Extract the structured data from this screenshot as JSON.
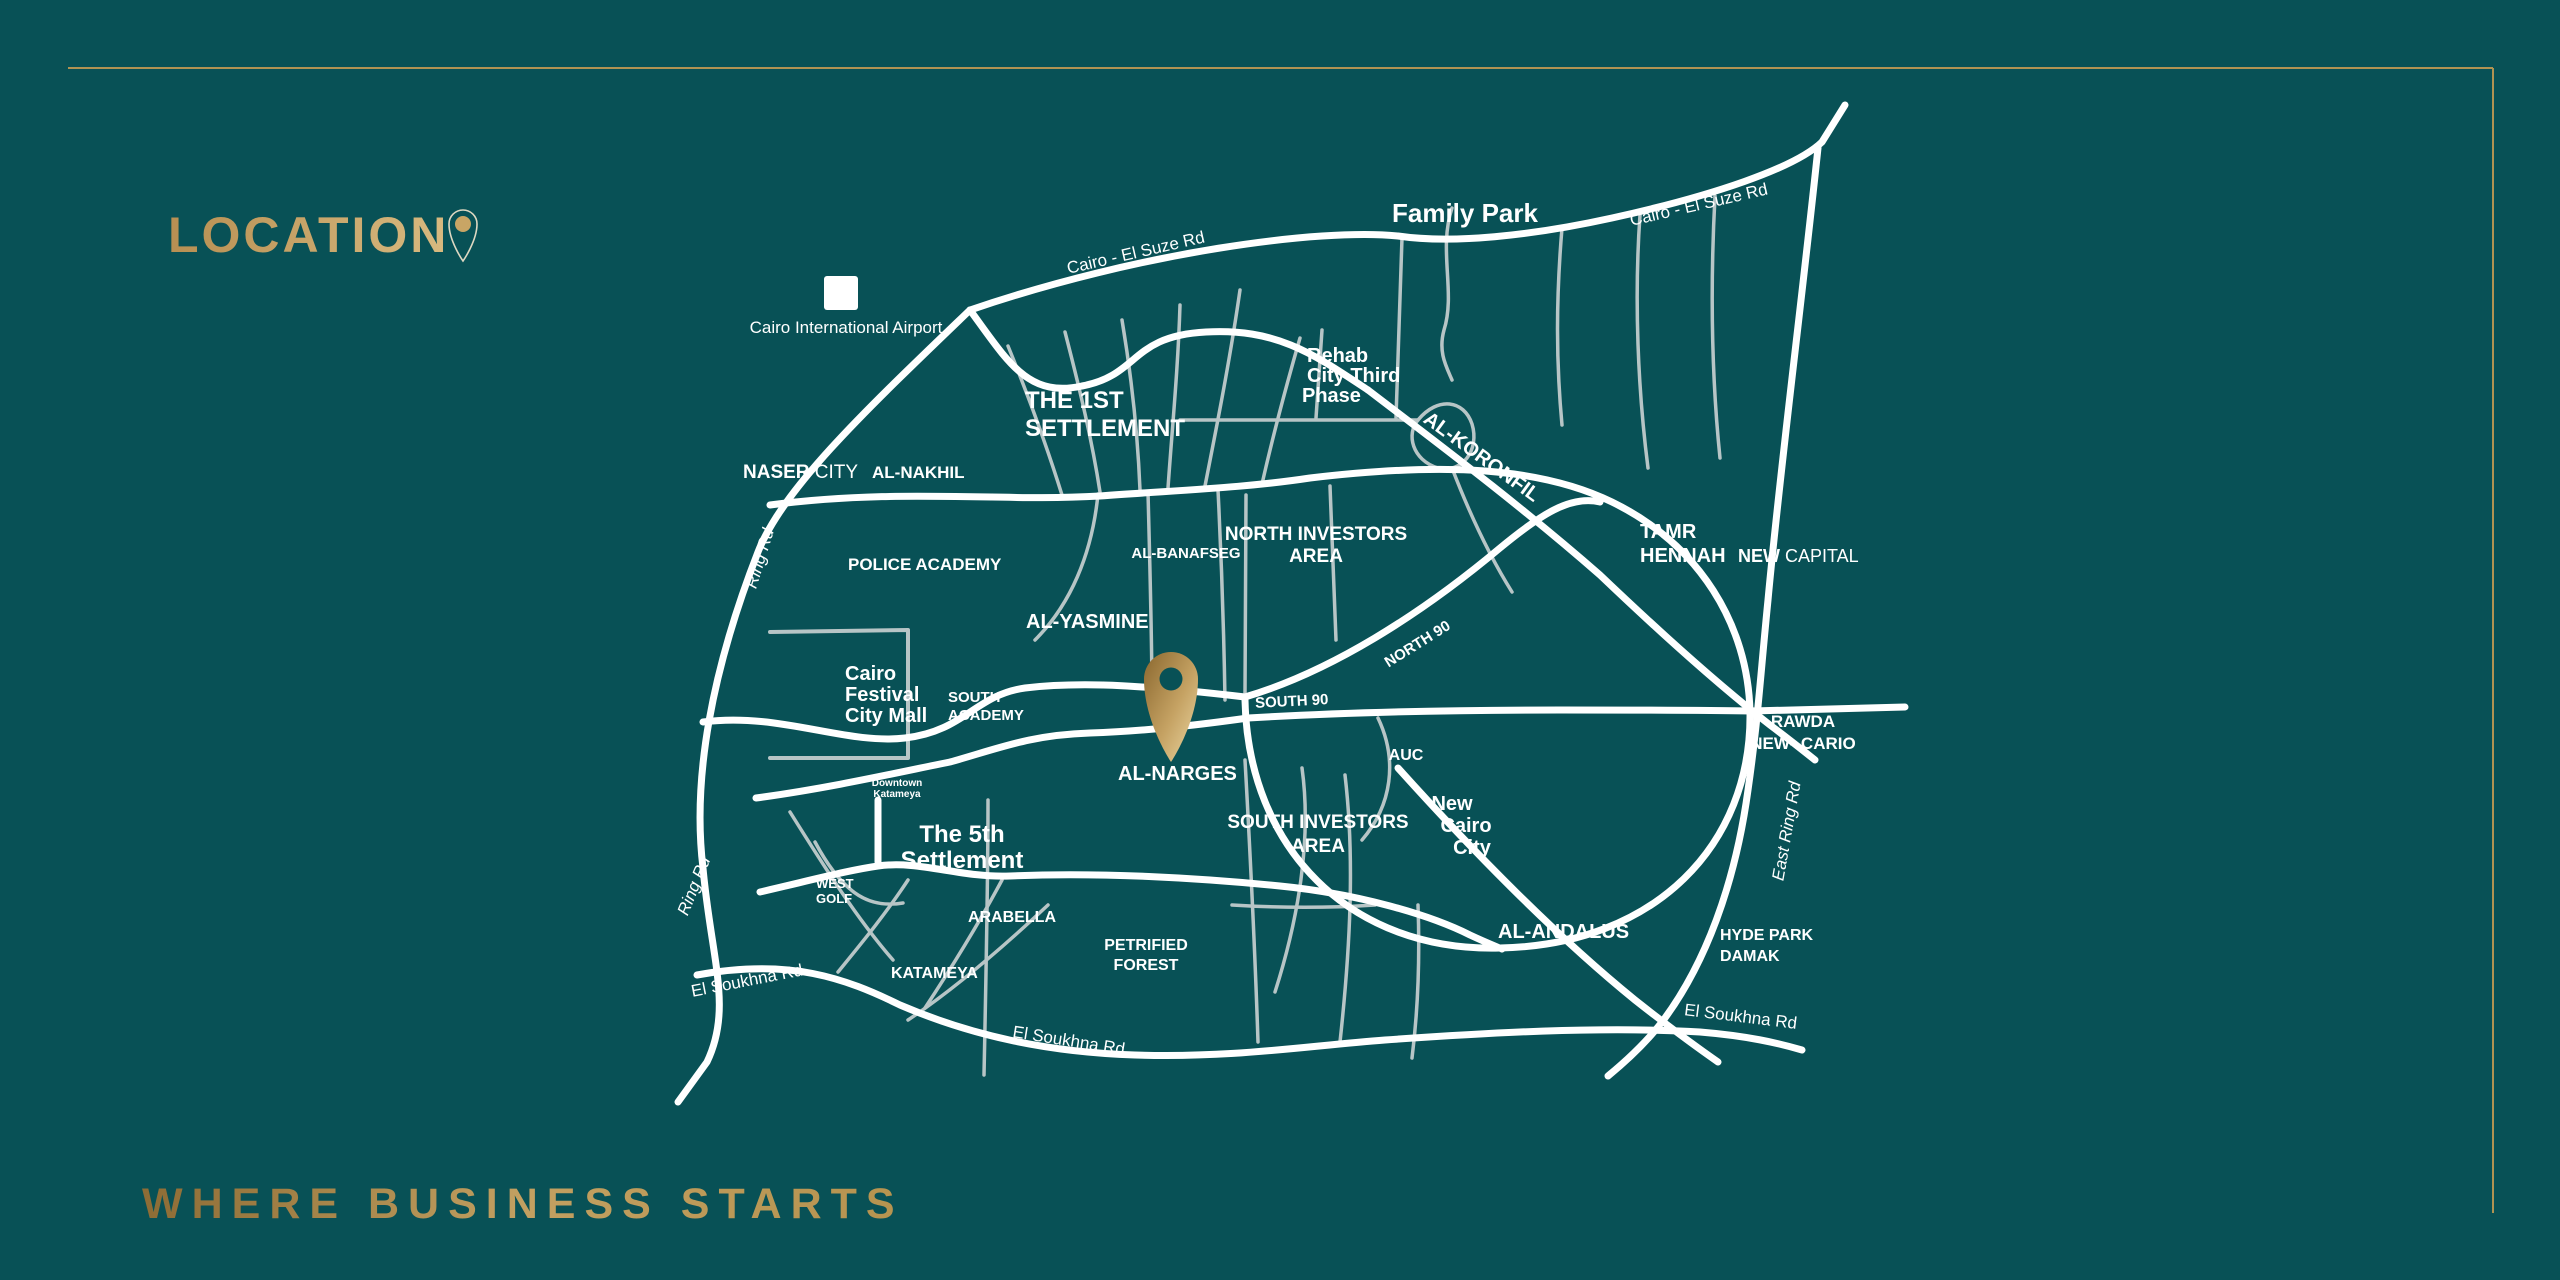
{
  "colors": {
    "background": "#085156",
    "gold": "#c2a063",
    "gold_dark": "#8f6f38",
    "road_primary": "#ffffff",
    "road_secondary": "#b7c5c6"
  },
  "header": {
    "title": "LOCATION"
  },
  "footer": {
    "tagline": "WHERE BUSINESS STARTS"
  },
  "map": {
    "airport": {
      "label": "Cairo International Airport"
    },
    "roads": {
      "suze_left": "Cairo - El Suze Rd",
      "suze_right": "Cairo - El Suze Rd",
      "ring_upper": "Ring Rd",
      "ring_lower": "Ring Rd",
      "east_ring": "East Ring Rd",
      "soukhna_left": "El Soukhna Rd",
      "soukhna_mid": "El Soukhna Rd",
      "soukhna_right": "El Soukhna Rd",
      "north90": "NORTH 90",
      "south90": "SOUTH 90"
    },
    "areas": {
      "family_park": "Family Park",
      "first_settlement_l1": "THE 1ST",
      "first_settlement_l2": "SETTLEMENT",
      "rehab_l1": "Rehab",
      "rehab_l2": "City Third",
      "rehab_l3": "Phase",
      "koronfil": "AL-KORONFIL",
      "naser_b": "NASER",
      "naser_r": " CITY",
      "nakhil": "AL-NAKHIL",
      "police": "POLICE ACADEMY",
      "banafseg": "AL-BANAFSEG",
      "north_inv_l1": "NORTH INVESTORS",
      "north_inv_l2": "AREA",
      "tamr_l1": "TAMR",
      "tamr_l2": "HENNAH",
      "new_capital_b": "NEW",
      "new_capital_r": " CAPITAL",
      "yasmine": "AL-YASMINE",
      "cfcm_l1": "Cairo",
      "cfcm_l2": "Festival",
      "cfcm_l3": "City Mall",
      "south_academy_l1": "SOUTH",
      "south_academy_l2": "ACADEMY",
      "downtown_l1": "Downtown",
      "downtown_l2": "Katameya",
      "narges": "AL-NARGES",
      "auc": "AUC",
      "south_inv_l1": "SOUTH INVESTORS",
      "south_inv_l2": "AREA",
      "new_cairo_l1": "New",
      "new_cairo_l2": "Cairo",
      "new_cairo_l3": "City",
      "fifth_l1": "The 5th",
      "fifth_l2": "Settlement",
      "west_golf_l1": "WEST",
      "west_golf_l2": "GOLF",
      "arabella": "ARABELLA",
      "katameya": "KATAMEYA",
      "petrified_l1": "PETRIFIED",
      "petrified_l2": "FOREST",
      "andalus": "AL-ANDALUS",
      "hyde_l1": "HYDE PARK",
      "hyde_l2": "DAMAK",
      "rawda_l1": "RAWDA",
      "rawda_l2": "NEW--CARIO"
    }
  }
}
